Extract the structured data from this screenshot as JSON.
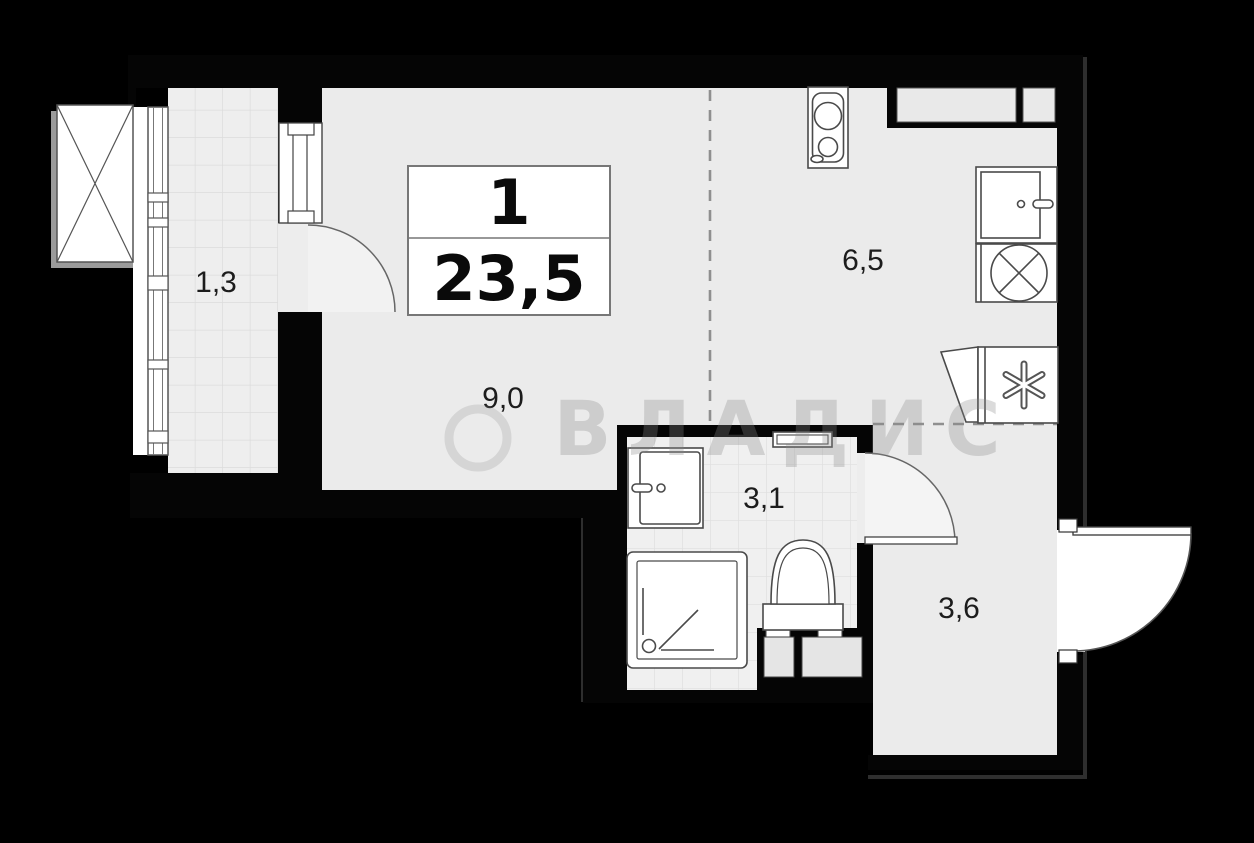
{
  "plan": {
    "type": "apartment-floor-plan",
    "title_block": {
      "rooms_count": "1",
      "total_area": "23,5"
    },
    "rooms": [
      {
        "id": "balcony",
        "area_label": "1,3"
      },
      {
        "id": "living-room",
        "area_label": "9,0"
      },
      {
        "id": "kitchen",
        "area_label": "6,5"
      },
      {
        "id": "bathroom",
        "area_label": "3,1"
      },
      {
        "id": "hallway",
        "area_label": "3,6"
      }
    ],
    "watermark": {
      "text": "ВЛАДИС"
    },
    "fixtures": [
      "stove",
      "kitchen-sink",
      "washing-machine",
      "refrigerator",
      "washbasin",
      "shower",
      "toilet",
      "towel-rail",
      "balcony-glazing",
      "ventilation-shaft"
    ],
    "colors": {
      "background": "#000000",
      "wall": "#050505",
      "floor": "#ebebeb",
      "tile_floor": "#efefef",
      "tile_line": "#dcdcdc",
      "fixture_fill": "#ffffff",
      "fixture_outline": "#4a4a4a",
      "dashed_zone_line": "#8f8f8f"
    }
  }
}
